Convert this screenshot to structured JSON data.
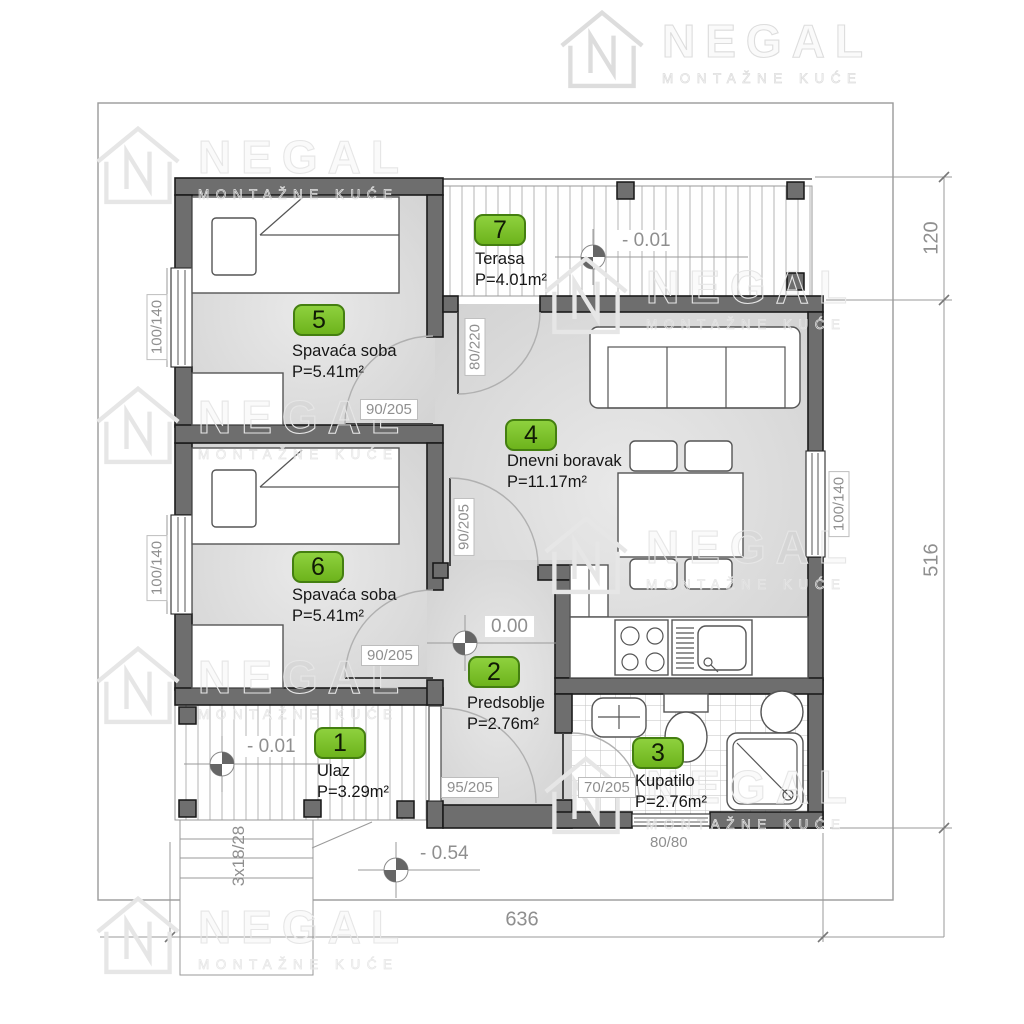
{
  "brand": {
    "name": "NEGAL",
    "tagline": "MONTAŽNE KUĆE"
  },
  "rooms": [
    {
      "number": "1",
      "name": "Ulaz",
      "area": "P=3.29m²"
    },
    {
      "number": "2",
      "name": "Predsoblje",
      "area": "P=2.76m²"
    },
    {
      "number": "3",
      "name": "Kupatilo",
      "area": "P=2.76m²"
    },
    {
      "number": "4",
      "name": "Dnevni boravak",
      "area": "P=11.17m²"
    },
    {
      "number": "5",
      "name": "Spavaća soba",
      "area": "P=5.41m²"
    },
    {
      "number": "6",
      "name": "Spavaća soba",
      "area": "P=5.41m²"
    },
    {
      "number": "7",
      "name": "Terasa",
      "area": "P=4.01m²"
    }
  ],
  "openings": {
    "terrace_door": "80/220",
    "room5_door": "90/205",
    "room6_door": "90/205",
    "living_door": "90/205",
    "entry_door": "95/205",
    "bath_door": "70/205",
    "room5_window": "100/140",
    "room6_window": "100/140",
    "living_window": "100/140",
    "bath_window": "80/80"
  },
  "elevations": {
    "terrace": "- 0.01",
    "porch": "- 0.01",
    "hall": "0.00",
    "ground": "- 0.54"
  },
  "dimensions": {
    "total_width": "636",
    "main_depth": "516",
    "terrace_depth": "120",
    "stairs": "3x18/28"
  },
  "colors": {
    "badge_green": "#7cc32a",
    "badge_border": "#447f10",
    "wall_gray": "#6e6e6e"
  }
}
